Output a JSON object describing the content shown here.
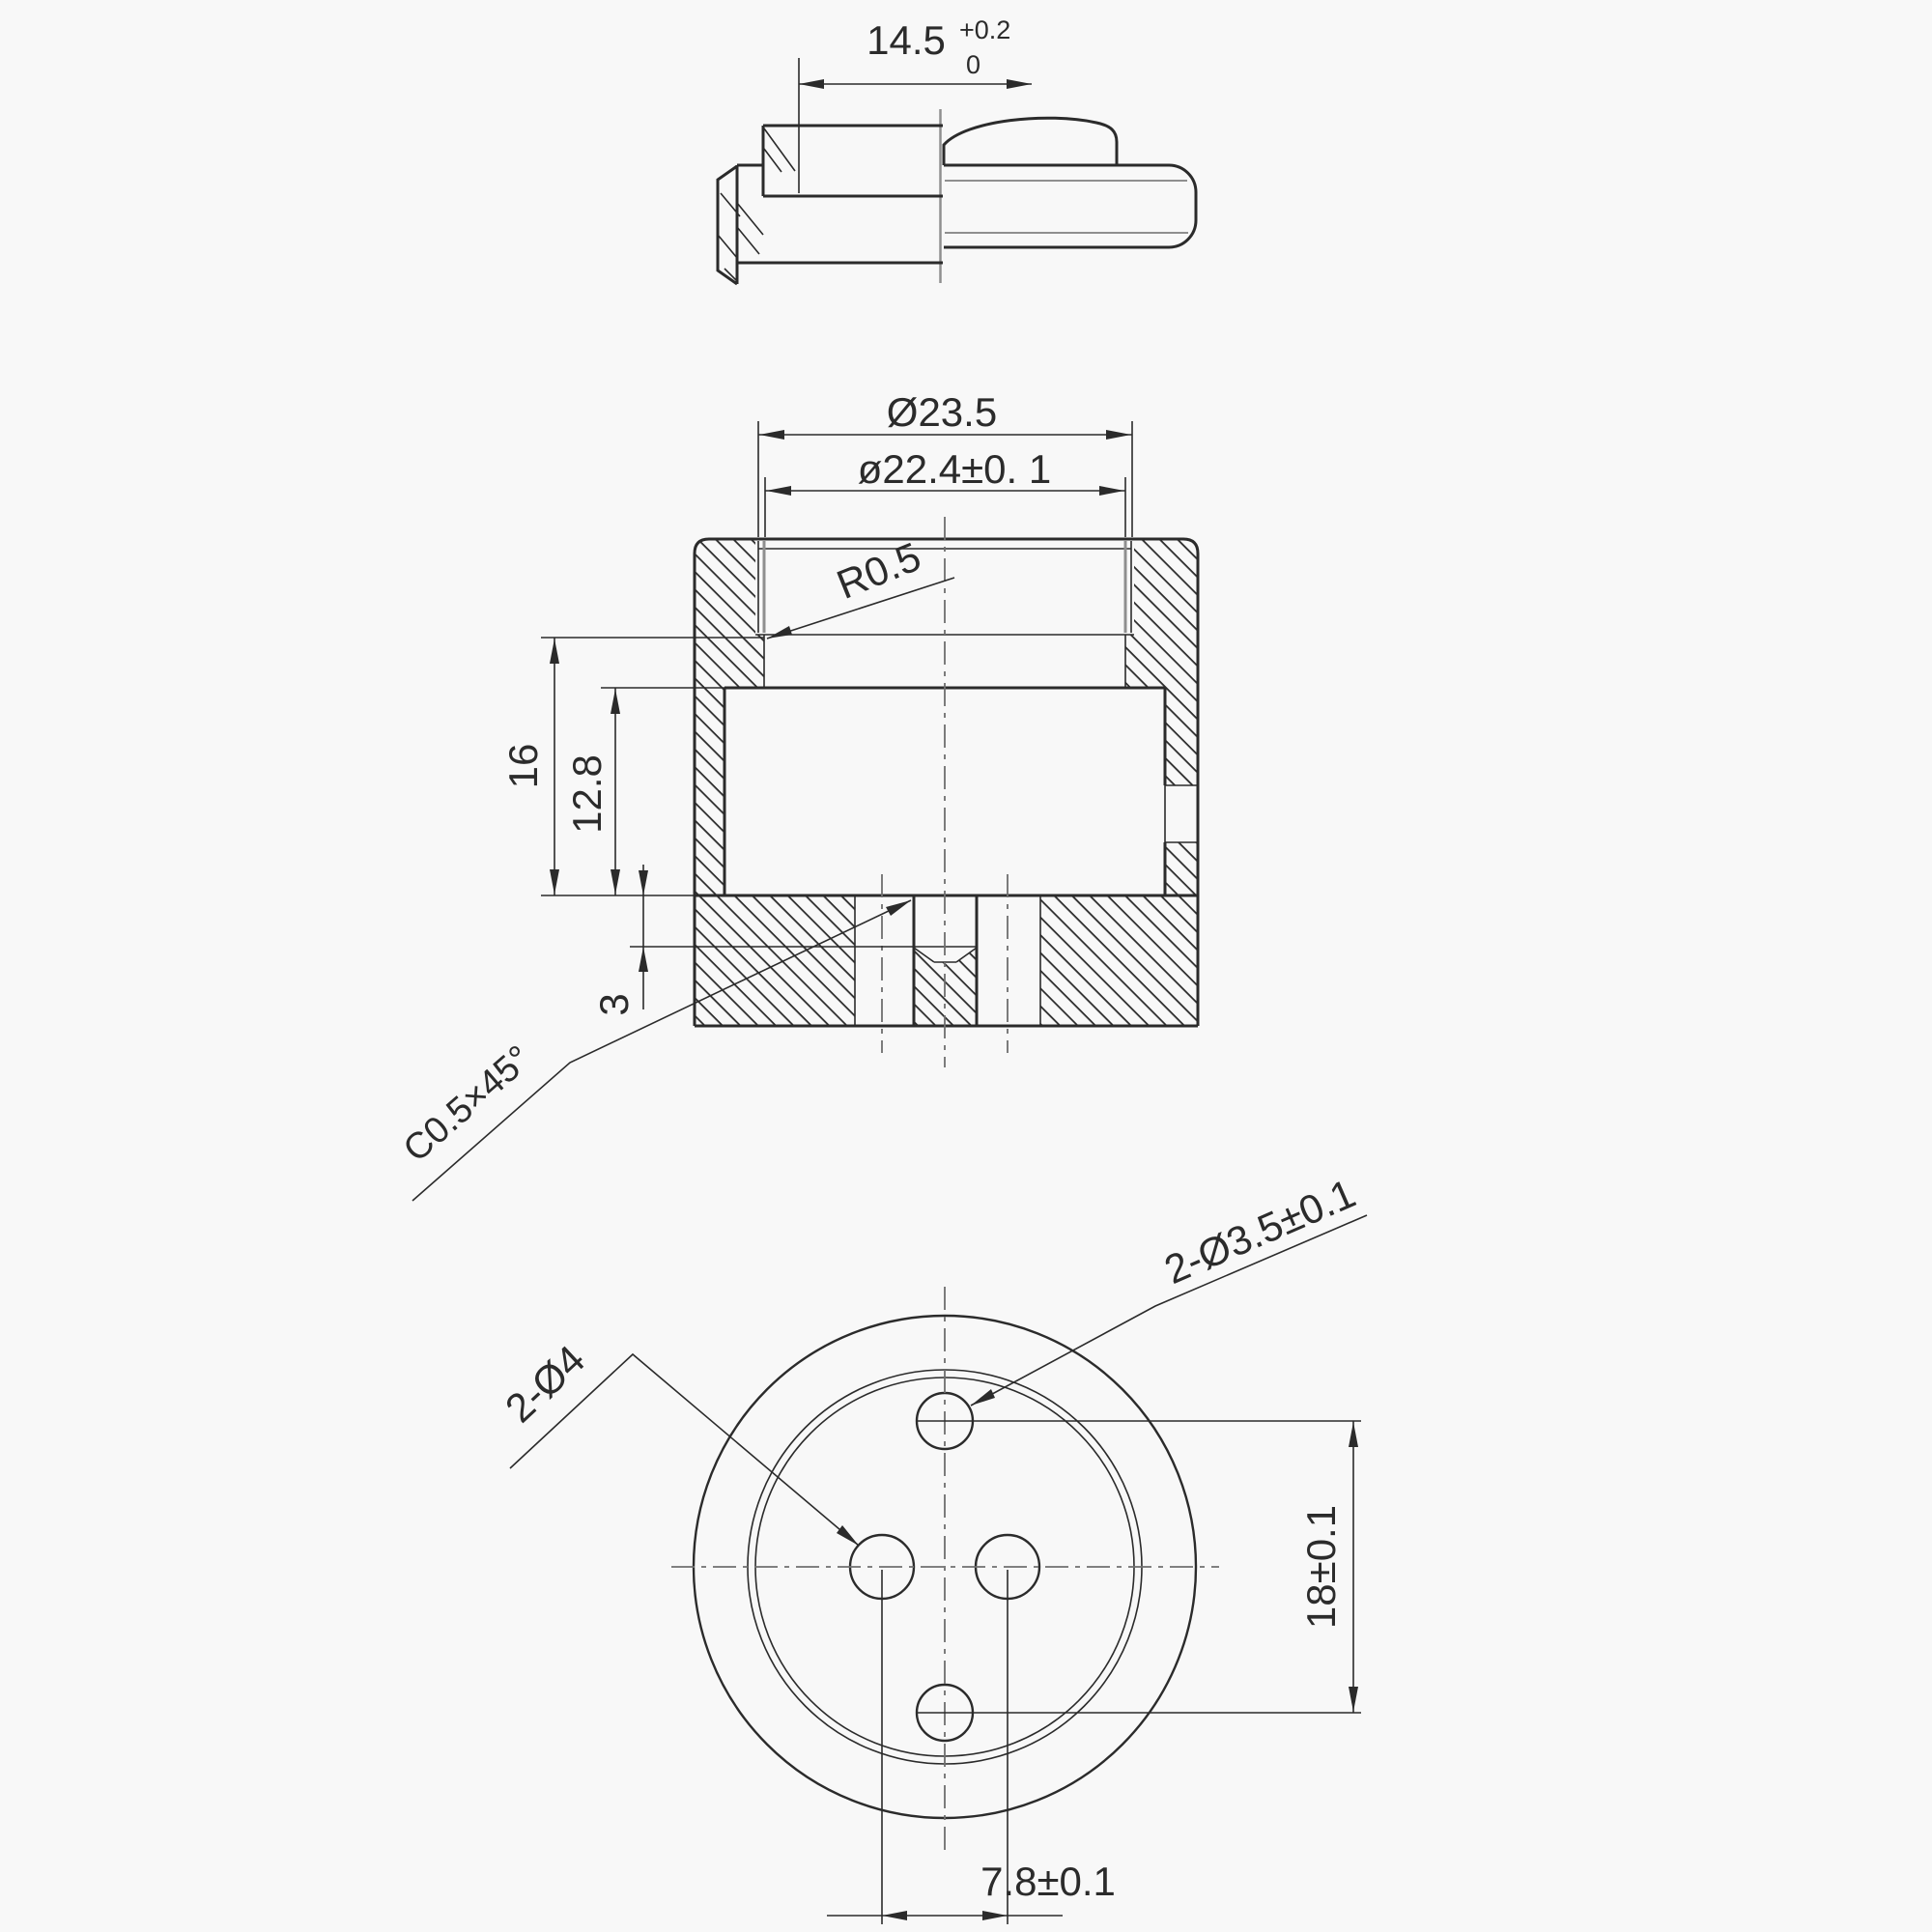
{
  "drawing": {
    "type": "engineering-drawing",
    "views": [
      "side profile",
      "cross section",
      "bottom view"
    ],
    "colors": {
      "ink": "#2b2b2b",
      "gray": "#8f8f8f",
      "background": "#f8f8f8"
    },
    "labels": {
      "top_view": {
        "length": "14.5",
        "tol_upper": "+0.2",
        "tol_lower": "0"
      },
      "section_view": {
        "outer_diameter": "Ø23.5",
        "thread_diameter": "ø22.4±0. 1",
        "fillet_radius": "R0.5",
        "height_total": "16",
        "height_cavity": "12.8",
        "step_depth": "3",
        "chamfer": "C0.5×45°"
      },
      "bottom_view": {
        "small_holes": "2-Ø3.5±0.1",
        "large_holes": "2-Ø4",
        "vertical_pitch": "18±0.1",
        "horizontal_pitch": "7.8±0.1"
      }
    }
  }
}
